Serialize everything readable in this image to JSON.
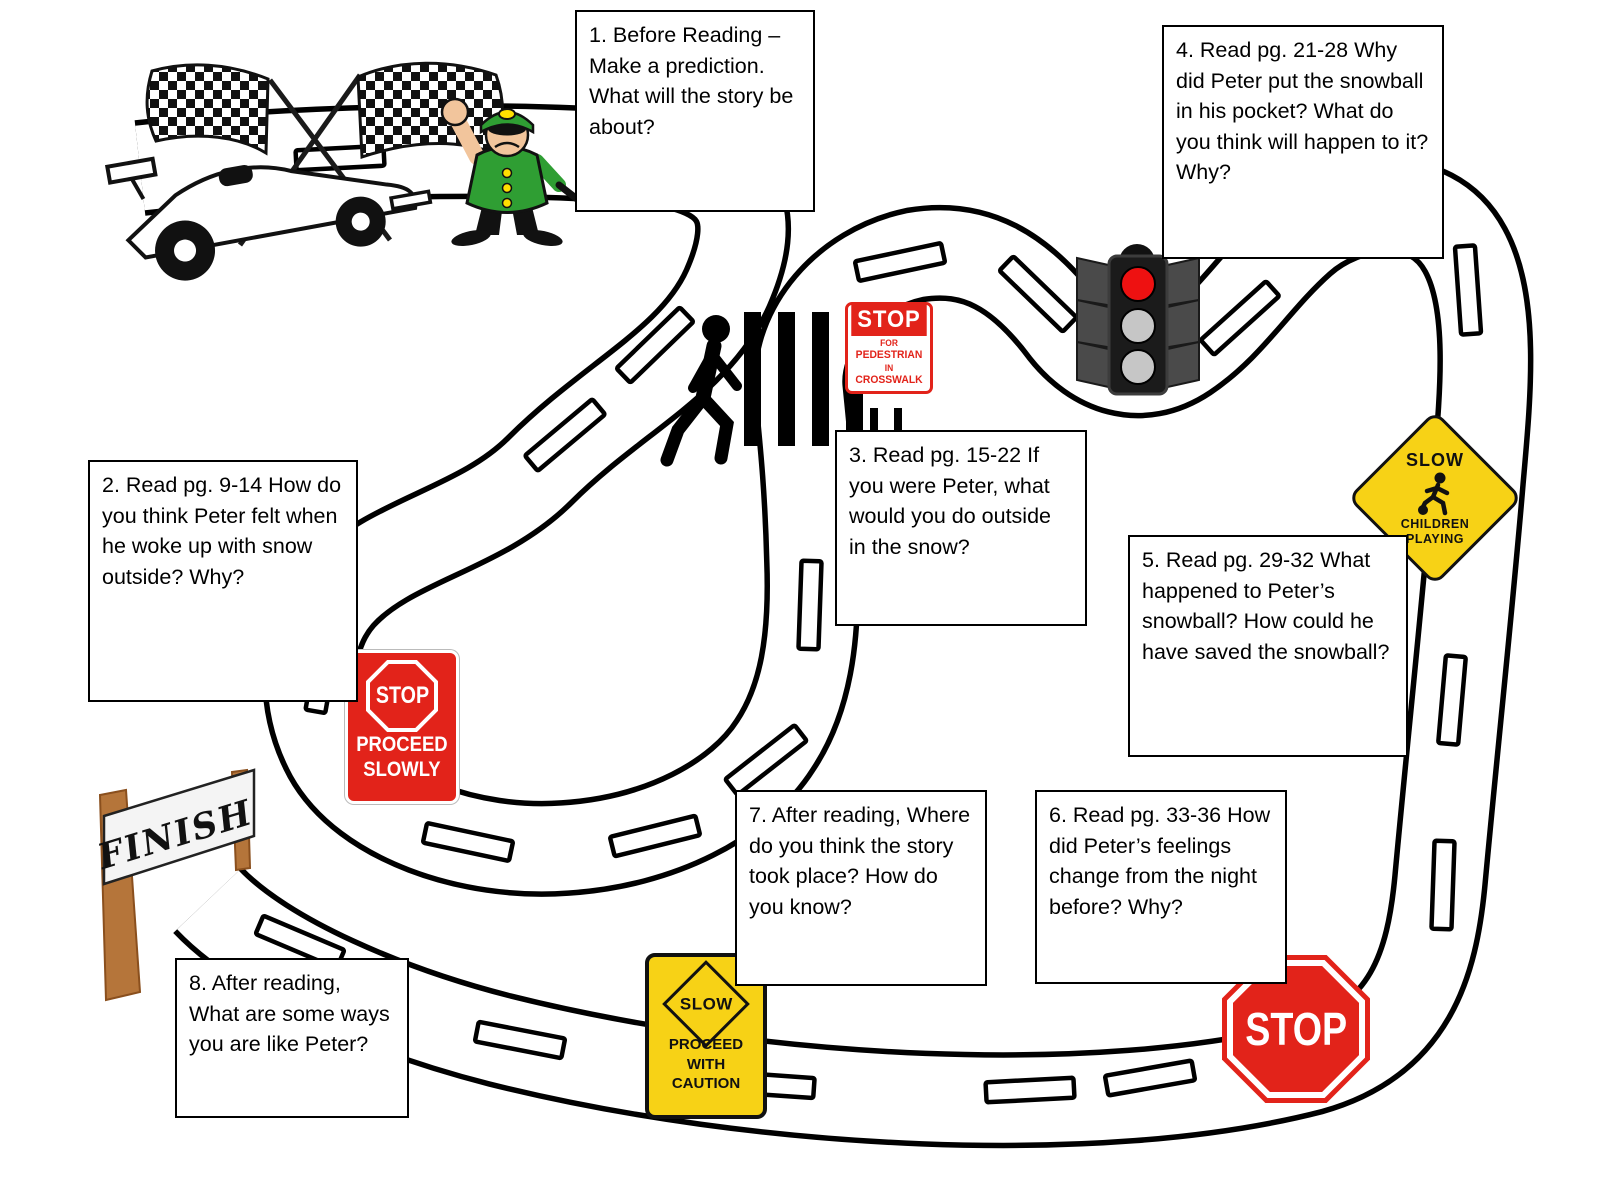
{
  "board": {
    "boxes": [
      {
        "text": "1. Before Reading – Make a prediction. What will the story be about?"
      },
      {
        "text": "2. Read pg. 9-14 How do you think Peter felt when he woke up with snow outside? Why?"
      },
      {
        "text": "3. Read pg. 15-22 If you were Peter, what would you do outside in the snow?"
      },
      {
        "text": "4. Read pg. 21-28 Why did Peter put the snowball in his pocket? What do you think will happen to it? Why?"
      },
      {
        "text": "5. Read pg. 29-32 What happened to Peter’s snowball? How could he have saved the snowball?"
      },
      {
        "text": "6. Read pg. 33-36 How did Peter’s feelings change from the night before? Why?"
      },
      {
        "text": "7. After reading, Where do you think the story took place? How do you know?"
      },
      {
        "text": "8. After reading, What are some ways you are like Peter?"
      }
    ],
    "signs": {
      "pedestrian_stop": {
        "stop": "STOP",
        "l1": "FOR",
        "l2": "PEDESTRIAN",
        "l3": "IN",
        "l4": "CROSSWALK"
      },
      "proceed_slowly": {
        "stop": "STOP",
        "l1": "PROCEED",
        "l2": "SLOWLY"
      },
      "children_playing": {
        "top": "SLOW",
        "l1": "CHILDREN",
        "l2": "PLAYING"
      },
      "proceed_caution": {
        "top": "SLOW",
        "l1": "PROCEED",
        "l2": "WITH",
        "l3": "CAUTION"
      },
      "stop_octagon": {
        "label": "STOP"
      },
      "finish_banner": {
        "label": "FINISH"
      }
    },
    "icons": {
      "race_car": "race-car with crossed checkered flags",
      "crossing_guard": "crossing-guard holding hand up",
      "pedestrian": "pedestrian walking in crosswalk",
      "traffic_light": "traffic-light with red lit"
    },
    "colors": {
      "sign_red": "#e2231a",
      "sign_yellow": "#f7d216",
      "uniform_green": "#2f9e33",
      "traffic_red": "#ee1111",
      "wood_brown": "#b5753a"
    }
  }
}
